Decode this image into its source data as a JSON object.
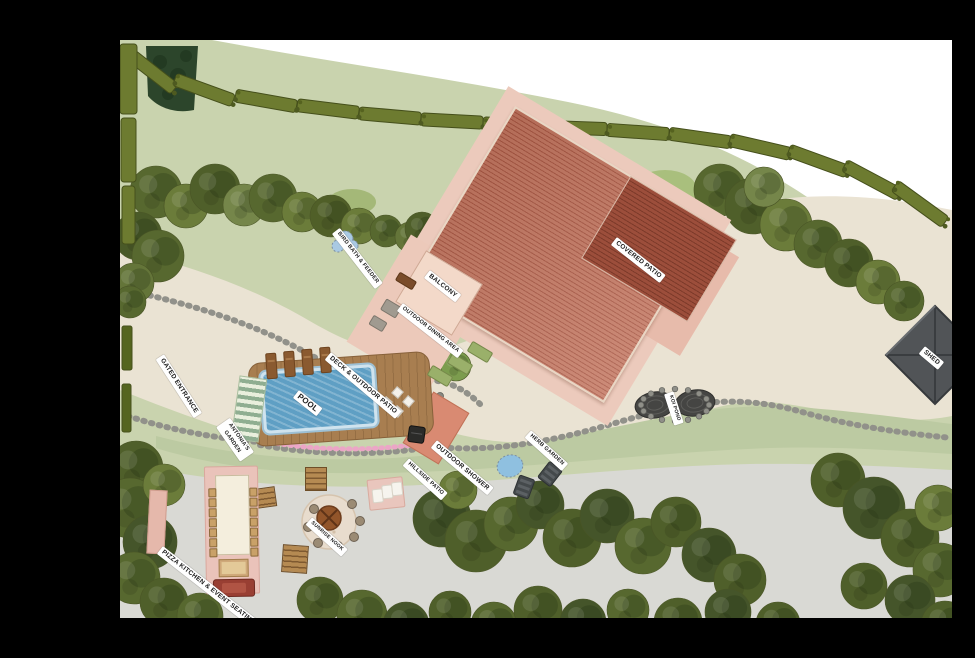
{
  "map": {
    "labels": [
      {
        "id": "gated-entrance",
        "text": "GATED ENTRANCE"
      },
      {
        "id": "bird-bath",
        "text": "BIRD BATH & FEEDER"
      },
      {
        "id": "balcony",
        "text": "BALCONY"
      },
      {
        "id": "outdoor-dining",
        "text": "OUTDOOR DINING AREA"
      },
      {
        "id": "covered-patio",
        "text": "COVERED PATIO"
      },
      {
        "id": "shed",
        "text": "SHED"
      },
      {
        "id": "deck-patio",
        "text": "DECK & OUTDOOR PATIO"
      },
      {
        "id": "pool",
        "text": "POOL"
      },
      {
        "id": "antonias-garden",
        "text": "ANTONIA'S GARDEN"
      },
      {
        "id": "koi-pond",
        "text": "KOI POND"
      },
      {
        "id": "herb-garden",
        "text": "HERB GARDEN"
      },
      {
        "id": "outdoor-shower",
        "text": "OUTDOOR SHOWER"
      },
      {
        "id": "hillside-patio",
        "text": "HILLSIDE PATIO"
      },
      {
        "id": "sunrise-nook",
        "text": "SUNRISE NOOK"
      },
      {
        "id": "pizza-kitchen",
        "text": "PIZZA KITCHEN & EVENT SEATING"
      }
    ],
    "palette": {
      "background": "#000000",
      "out_of_bounds": "#ffffff",
      "grass": "#c9d3ae",
      "driveway_gravel": "#eae3d3",
      "lower_gravel": "#d9d9d4",
      "sage_band": "#bccaa2",
      "roof_terracotta": "#c47862",
      "roof_covered": "#9c4e3b",
      "patio_blush": "#eccabc",
      "pool_water": "#5f9fc4",
      "deck_wood": "#a87e50",
      "hedge_olive": "#6d7b30",
      "tree_green": "#57682f",
      "shed_gray": "#515457",
      "flower_pink": "#eba6c6",
      "water_light": "#a9c9e3"
    }
  }
}
